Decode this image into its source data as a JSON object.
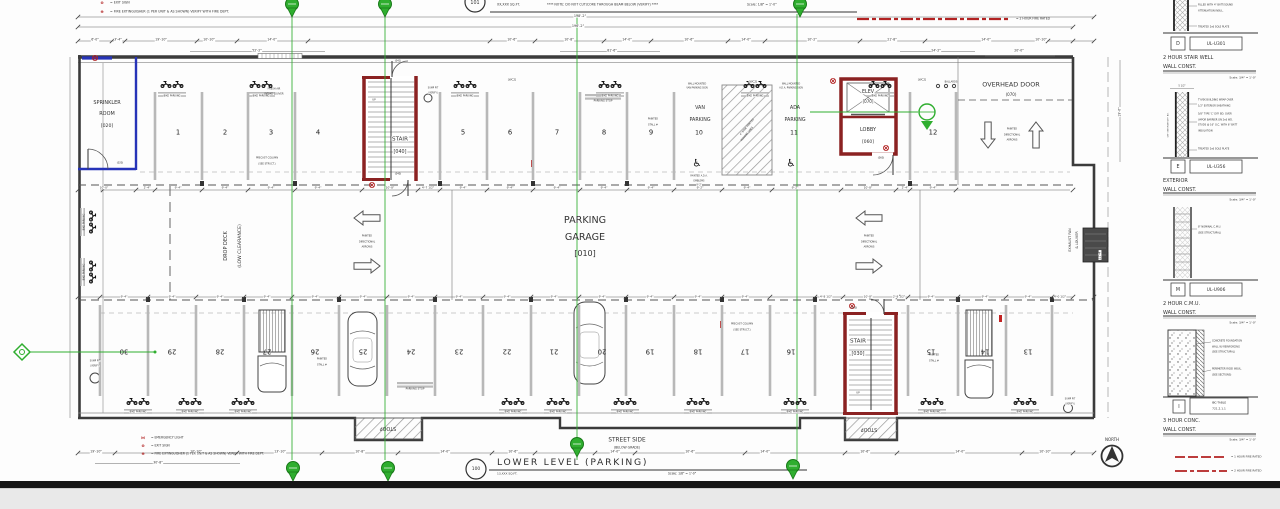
{
  "colors": {
    "line": "#3b3b3b",
    "green_keynote": "#2fae2f",
    "fire_rated_red": "#8b2222",
    "legend_red": "#b22222",
    "sprinkler_blue": "#2633b8",
    "divider_gray": "#b8b8b8"
  },
  "icons": {
    "wheelchair": "♿",
    "exit_sign": "⊗",
    "fire_extinguisher": "⊕",
    "emergency_light": "⋈",
    "north_arrow": "circle-arrow-up",
    "keynote_balloon": "green-pin",
    "bike_parking": "bike-glyph",
    "car": "car-outline",
    "truck": "truck-outline",
    "directional_arrow": "hollow-arrow"
  },
  "top_strip": {
    "ref": "101",
    "note": "XX,XXX SQ.FT.",
    "note2": "**** NOTE: DO NOT CUT/CORE THROUGH BEAM BELOW (VERIFY) ****",
    "scale": "Scale:  1/8\" = 1'-0\"",
    "fire_legend": "= 2 HOUR FIRE RATED",
    "legend": [
      {
        "sym": "⊗",
        "text": "= EXIT SIGN"
      },
      {
        "sym": "⊕",
        "text": "= FIRE EXTINGUISHER (1 PER UNIT & AS SHOWN) VERIFY WITH FIRE DEPT."
      }
    ]
  },
  "plan": {
    "overall_dim_1": "198'-2\"",
    "overall_dim_2": "196'-2\"",
    "top_dims": [
      "6'-0\"",
      "3'-4\"",
      "19'-10\"",
      "10'-10\"",
      "14'-0\"",
      "10'-6\"",
      "10'-8\"",
      "14'-0\"",
      "10'-6\"",
      "14'-0\"",
      "10'-2\"",
      "21'-8\"",
      "14'-0\"",
      "10'-10\""
    ],
    "top_dims2": [
      "52'-2\"",
      "81'-6\"",
      "24'-2\"",
      "20'-0\""
    ],
    "bottom_dims": [
      "19'-10\"",
      "10'-10\"",
      "13'-10\"",
      "10'-8\"",
      "14'-0\"",
      "10'-6\"",
      "14'-0\"",
      "10'-6\"",
      "14'-0\"",
      "10'-6\"",
      "14'-0\"",
      "10'-10\""
    ],
    "bottom_dims2": [
      "30'-8\""
    ],
    "stall_dim": "9'-4\"",
    "top_dim_specials": [
      "10'-0\"",
      "2'-4\"",
      "10'-8\"",
      "4'-7 1/2\"",
      "9'-2\"",
      "9'-2\"",
      "10'-8\"",
      "2'-4\""
    ],
    "bottom_dim_specials": [
      "4'-8 1/2\"",
      "10'-8\"",
      "2'-8 1/2\"",
      "4'-0 1/2\""
    ],
    "side_dims": [
      "19'-6\"",
      "11'-4\""
    ],
    "top_stalls": [
      "1",
      "2",
      "3",
      "4",
      "5",
      "6",
      "7",
      "8",
      "9",
      "12"
    ],
    "bottom_stalls": [
      "30",
      "29",
      "28",
      "27",
      "26",
      "25",
      "24",
      "23",
      "22",
      "21",
      "20",
      "19",
      "18",
      "17",
      "16",
      "15",
      "14",
      "13"
    ],
    "rooms": {
      "sprinkler": [
        "SPRINKLER",
        "ROOM",
        "[020]"
      ],
      "stair040": [
        "STAIR",
        "[040]"
      ],
      "stair030": [
        "STAIR",
        "[030]"
      ],
      "elev": [
        "ELEV",
        "[070]"
      ],
      "lobby": [
        "LOBBY",
        "[060]"
      ],
      "garage": [
        "PARKING",
        "GARAGE",
        "[010]"
      ],
      "van": [
        "VAN",
        "PARKING",
        "10"
      ],
      "ada": [
        "ADA",
        "PARKING",
        "11"
      ],
      "overhead": [
        "OVERHEAD DOOR",
        "(070)"
      ],
      "dropdeck": [
        "DROP DECK",
        "(LOW CLEARANCE)"
      ],
      "exhaust": [
        "EXHAUST FAN",
        "& LOUVER"
      ]
    },
    "notes": {
      "fresh_air": [
        "FRESH AIR",
        "INTAKE LOUVER"
      ],
      "precast": [
        "PRECAST COLUMN",
        "(SEE STRUCT.)"
      ],
      "painted_stall": [
        "PAINTED",
        "STALL #"
      ],
      "parking_stop": "PARKING STOP",
      "bike_parking": "BIKE PARKING",
      "wall_mounted_van": [
        "WALL MOUNTED",
        "VAN PARKING SIGN"
      ],
      "wall_mounted_ada": [
        "WALL MOUNTED",
        "A.D.A. PARKING SIGN"
      ],
      "ada_emblems": [
        "PAINTED A.D.A.",
        "EMBLEMS",
        "9'-2\""
      ],
      "painted_lines": [
        "4\" WIDE PAINTED",
        "PARKING LINES"
      ],
      "painted_arrows": [
        "PAINTED",
        "DIRECTIONAL",
        "ARROWS"
      ],
      "sump": [
        "SUMP PIT",
        "(VERIFY)"
      ],
      "wc2": "[WC2]",
      "ballards": "BALLARDS",
      "stoop": "STOOP",
      "street_side": [
        "STREET SIDE",
        "(BELOW GRADE)"
      ],
      "up": "UP",
      "doors": [
        "(020)",
        "(040)",
        "(041)",
        "(030)",
        "(060)"
      ]
    },
    "north_label": "NORTH"
  },
  "legend_bottom": [
    {
      "sym": "⋈",
      "text": "= EMERGENCY LIGHT"
    },
    {
      "sym": "⊗",
      "text": "= EXIT SIGN"
    },
    {
      "sym": "⊕",
      "text": "= FIRE EXTINGUISHER (1 PER UNIT & AS SHOWN) VERIFY WITH FIRE DEPT."
    }
  ],
  "fire_legend_br": [
    "= 1 HOUR FIRE RATED",
    "= 2 HOUR FIRE RATED"
  ],
  "title_block": {
    "ref": "100",
    "title": "LOWER LEVEL (PARKING)",
    "area": "13,XXX SQ.FT.",
    "scale": "Scale:  1/8\" = 1'-0\""
  },
  "details_panel": [
    {
      "tag": "D",
      "ul": "UL-U301",
      "title1": "2 HOUR STAIR WELL",
      "title2": "WALL CONST.",
      "scale": "Scale: 3/4\" = 1'-0\"",
      "annotations": [
        "FILLED WITH 4\" BATT/SOUND",
        "ATTENUATION INSUL.",
        "TREATED 2x6 SOLE PLATE"
      ]
    },
    {
      "tag": "E",
      "ul": "UL-U356",
      "title1": "EXTERIOR",
      "title2": "WALL CONST.",
      "scale": "Scale: 3/4\" = 1'-0\"",
      "dim": "5 1/2\"",
      "side": "5/8\" EXTERIOR GYP. BD.",
      "annotations": [
        "TYVEK BUILDING WRAP OVER",
        "1/2\" EXTERIOR SHEATHING",
        "5/8\" TYPE 'C' GYP. BD. OVER",
        "VAPOR BARRIER ON 2x6 WD.",
        "STUDS @ 16\" O.C. WITH 6\" BATT",
        "INSULATION",
        "TREATED 2x6 SOLE PLATE"
      ]
    },
    {
      "tag": "M",
      "ul": "UL-U906",
      "title1": "2 HOUR C.M.U.",
      "title2": "WALL CONST.",
      "scale": "Scale: 3/4\" = 1'-0\"",
      "annotations": [
        "8\" NOMINAL C.M.U.",
        "(SEE STRUCTURAL)"
      ]
    },
    {
      "tag": "I",
      "ul1": "IBC-TABLE",
      "ul2": "721.2.1.1",
      "title1": "3 HOUR CONC.",
      "title2": "WALL CONST.",
      "scale": "Scale: 3/4\" = 1'-0\"",
      "annotations": [
        "CONCRETE FOUNDATION",
        "WALL W/ REINFORCING",
        "(SEE STRUCTURAL)",
        "PERIMETER RIGID INSUL.",
        "(SEE SECTIONS)"
      ]
    }
  ]
}
